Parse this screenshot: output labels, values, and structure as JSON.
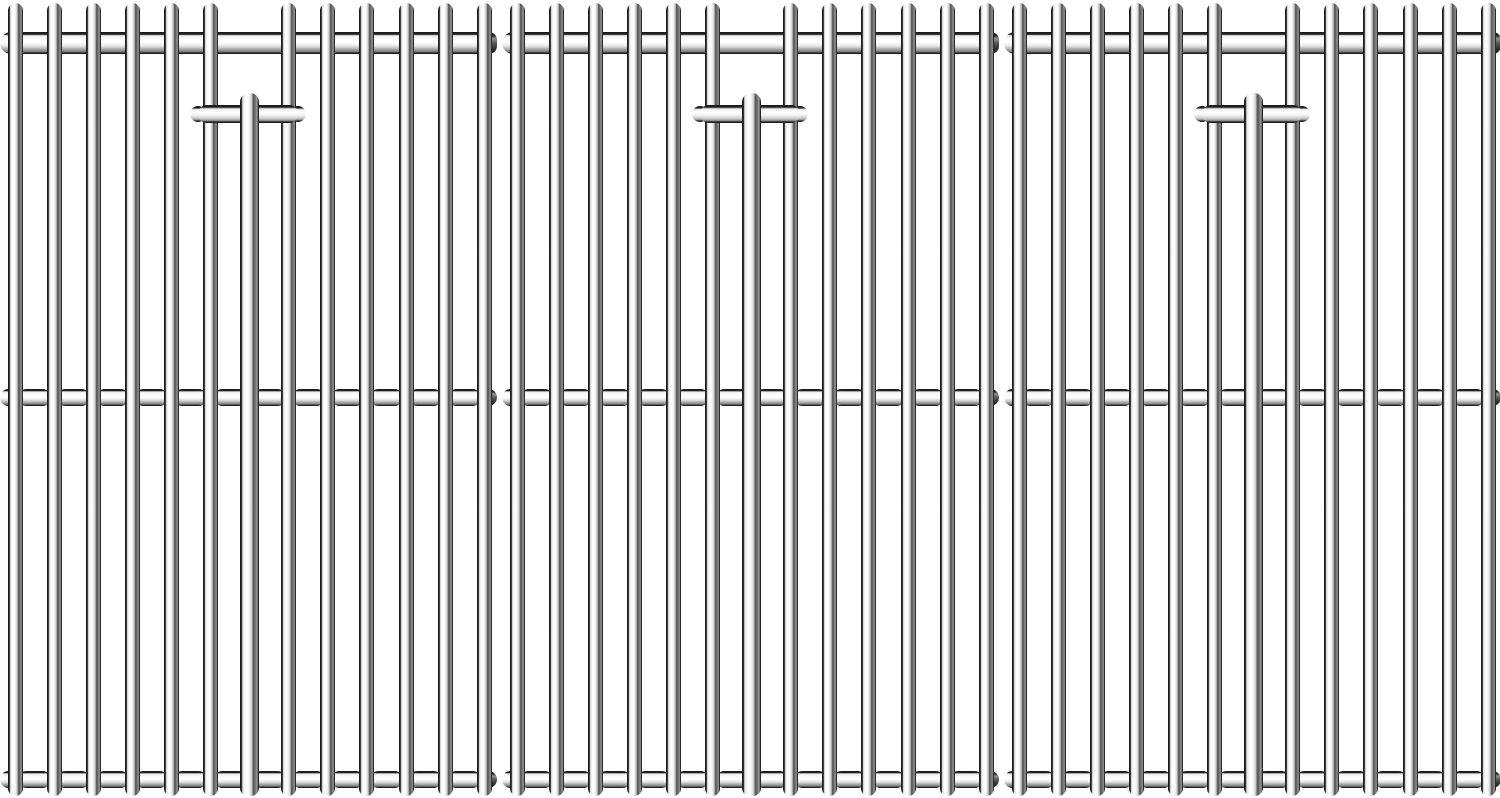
{
  "page": {
    "background_color": "#ffffff"
  },
  "illustration": {
    "subject": "stainless-steel-grill-cooking-grates",
    "style": "monochrome line-art product illustration",
    "grate_count": 3,
    "canvas": {
      "width": 1500,
      "height": 798
    },
    "grate_offsets_x": [
      0,
      502,
      1004
    ],
    "grate": {
      "width": 497,
      "height": 798,
      "columns": 13,
      "first_bar_center_x": 15,
      "bar_spacing": 39.1,
      "bar_width": 15,
      "bar_top_y": 3,
      "bar_bottom_y": 796,
      "thick_rod": {
        "column_index": 6,
        "width": 19,
        "top_y": 93
      },
      "top_rod": {
        "y": 32,
        "height": 22,
        "end_cap_width": 16
      },
      "mid_rod": {
        "y": 389,
        "height": 17
      },
      "bottom_rod": {
        "y": 771,
        "height": 17
      },
      "segment_inset": 3,
      "handle": {
        "x1": 190,
        "x2": 306,
        "y": 105,
        "height": 18,
        "nub_width": 16,
        "nub_y": 106,
        "nub_height": 16
      }
    },
    "colors": {
      "outline": "#1b1b1b",
      "steel_highlight": "#ffffff",
      "steel_light": "#f2f2f2",
      "steel_mid": "#c6c6c6",
      "steel_dark": "#515151",
      "end_cap_dark": "#3c3c3c",
      "background": "#ffffff"
    }
  }
}
